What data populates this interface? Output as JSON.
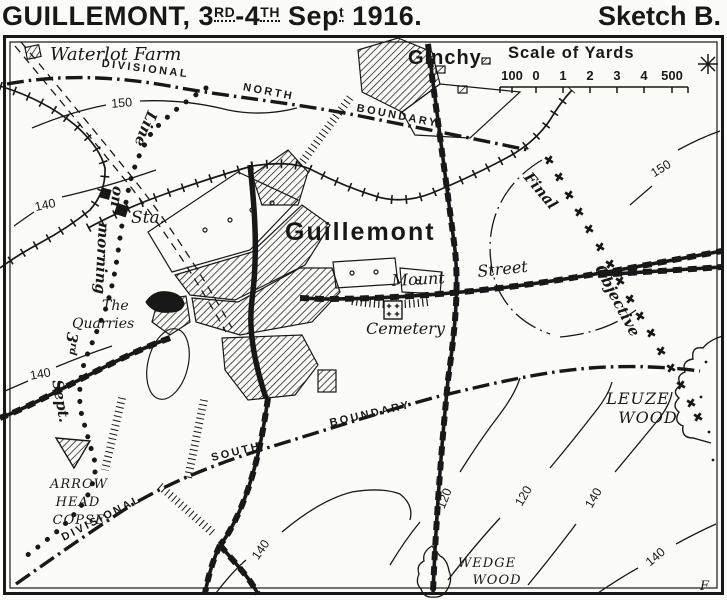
{
  "colors": {
    "ink": "#181818",
    "paper": "#fbfbf7"
  },
  "title": {
    "part1": "GUILLEMONT, 3",
    "sup1": "RD",
    "part2": "-4",
    "sup2": "TH",
    "part3": " Sep",
    "sup3": "t",
    "part4": " 1916.",
    "sketch": "Sketch B."
  },
  "scale": {
    "title": "Scale of Yards",
    "ticks": [
      "100",
      "0",
      "1",
      "2",
      "3",
      "4",
      "500"
    ]
  },
  "places": {
    "waterlot_farm": "Waterlot Farm",
    "ginchy": "Ginchy",
    "guillemont": "Guillemont",
    "mount": "Mount",
    "street": "Street",
    "cemetery": "Cemetery",
    "quarries_line1": "The",
    "quarries_line2": "Quarries",
    "station": "Sta.",
    "arrow_head_copse": [
      "ARROW",
      "HEAD",
      "COPSE"
    ],
    "leuze_wood": [
      "LEUZE",
      "WOOD"
    ],
    "wedge_wood": [
      "WEDGE",
      "WOOD"
    ]
  },
  "lines": {
    "north_boundary": [
      "DIVISIONAL",
      "NORTH",
      "BOUNDARY"
    ],
    "south_boundary": [
      "DIVISIONAL",
      "SOUTH",
      "BOUNDARY"
    ],
    "morning_line": [
      "Line",
      "on",
      "morning",
      "3",
      "Sept."
    ],
    "morning_sup": "rd",
    "final_objective": [
      "Final",
      "Objective"
    ]
  },
  "contours": {
    "v150": "150",
    "v140": "140",
    "v120": "120"
  },
  "signature": "F"
}
